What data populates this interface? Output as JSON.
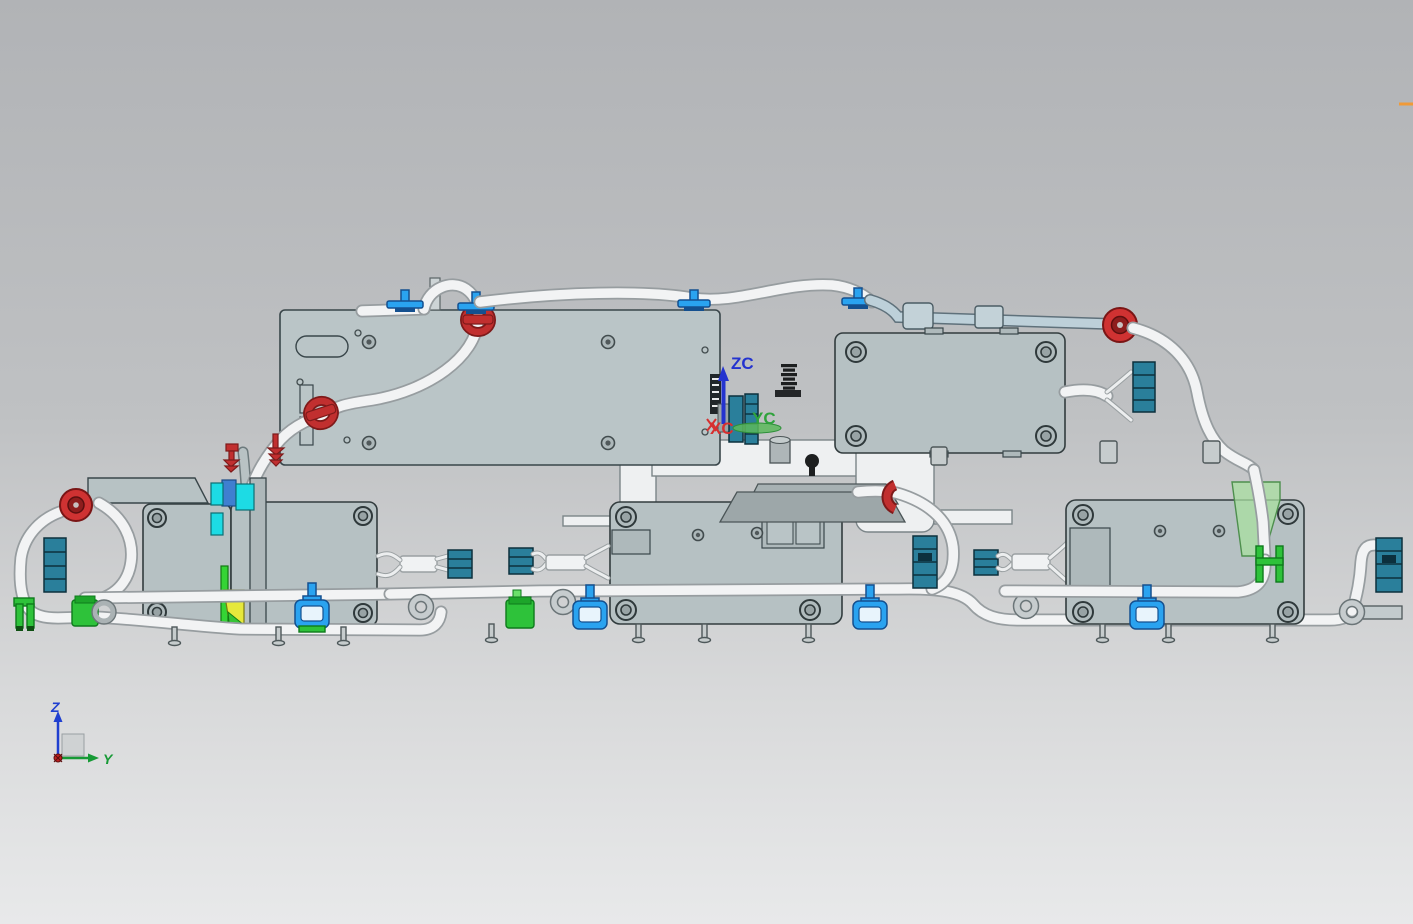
{
  "viewport": {
    "app_context": "cad-3d-model-view",
    "background": {
      "top_color": "#b1b3b6",
      "bottom_color": "#e8e9ea"
    },
    "wcs": {
      "zc_label": "ZC",
      "yc_label": "YC",
      "xc_label": "XC",
      "zc_color": "#2433cf",
      "yc_color": "#2fa33c",
      "xc_color": "#d63030"
    },
    "triad": {
      "z_label": "Z",
      "y_label": "Y",
      "z_color": "#1f3fd0",
      "y_color": "#169a35",
      "x_origin_color": "#c02020"
    },
    "highlight": {
      "dash_color": "#f09a38"
    },
    "palette": {
      "module_box_fill": "#b6c1c3",
      "module_box_stroke": "#323c3e",
      "harness_tube": "#f2f3f4",
      "metal_tube": "#bdd0d9",
      "clamp_red": "#c12f2f",
      "clip_blue": "#2aa3f0",
      "connector_teal": "#2a7f9b",
      "connector_green": "#2ec23a",
      "connector_cyan": "#1ddbe4",
      "wedge_yellow": "#e6e83c",
      "bracket_white": "#eef0f1"
    },
    "components": [
      "top-left-mounting-panel",
      "top-right-control-module",
      "left-control-modules",
      "middle-control-module",
      "right-control-module",
      "center-mounting-bracket",
      "wire-harness-tubes",
      "red-grommets-and-clamps",
      "blue-harness-clips",
      "teal-connectors",
      "green-connectors",
      "cyan-connectors",
      "standoff-posts",
      "eyelet-rings",
      "wcs-axis-indicator",
      "orientation-triad"
    ]
  }
}
